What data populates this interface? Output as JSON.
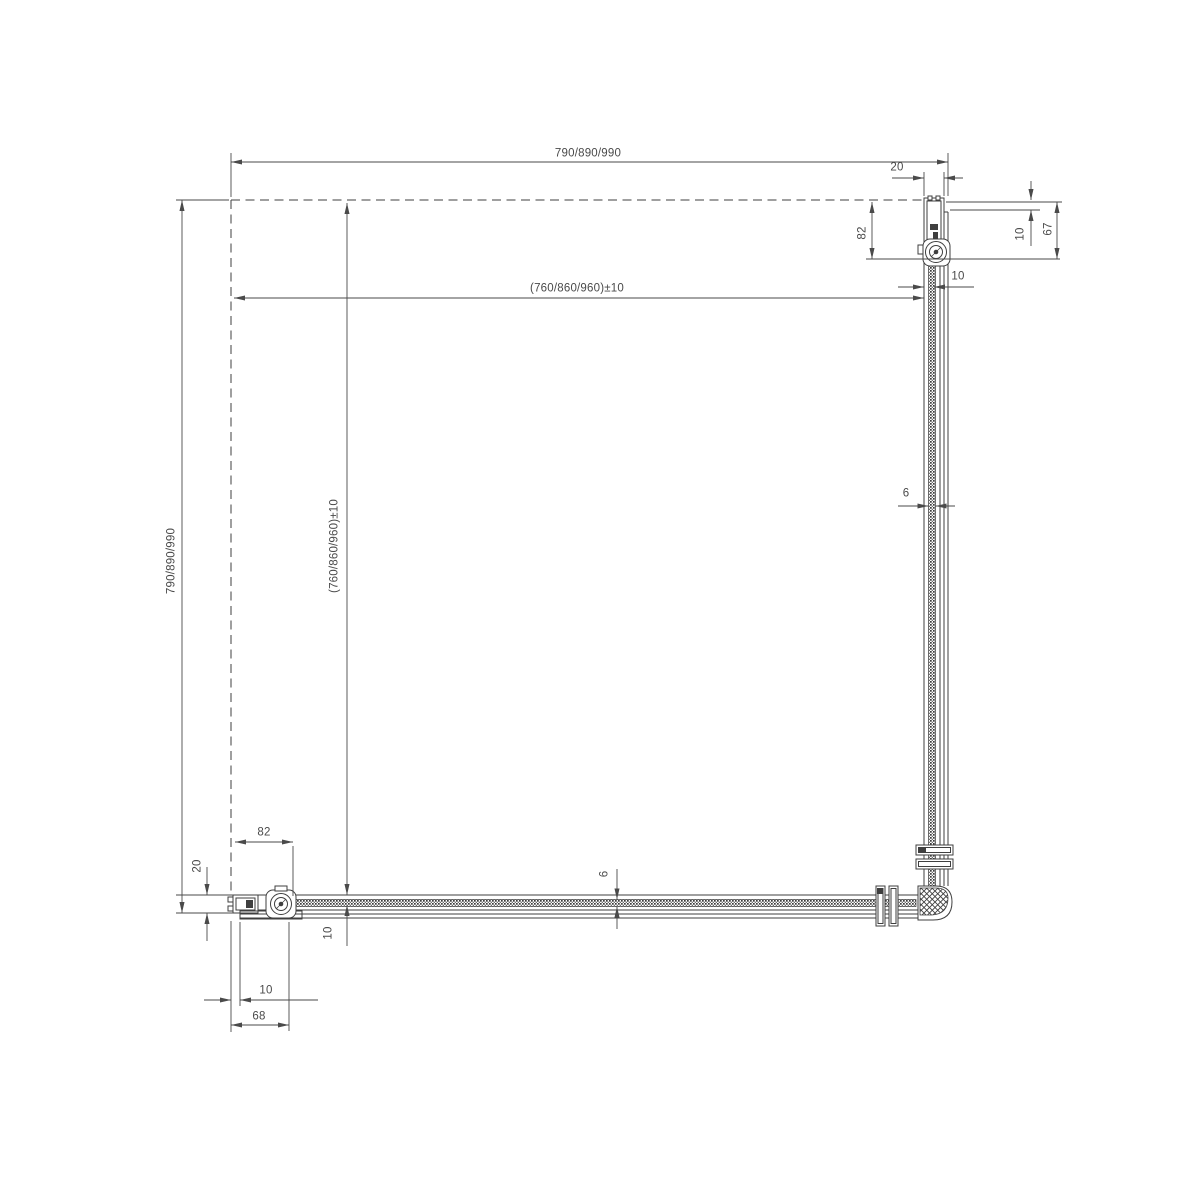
{
  "drawing": {
    "type": "shower-enclosure-corner-plan",
    "colors": {
      "background": "#ffffff",
      "line": "#3f3f3f",
      "dimension": "#4a4a4a"
    },
    "dimensions": {
      "width_overall": "790/890/990",
      "width_internal": "(760/860/960)±10",
      "height_overall": "790/890/990",
      "height_internal": "(760/860/960)±10",
      "top_profile_width": "20",
      "top_wall_to_roller": "82",
      "top_wall_gap": "10",
      "top_corner_depth": "67",
      "top_glass_gap": "10",
      "glass_thickness_side": "6",
      "glass_thickness_front": "6",
      "bottom_wall_to_roller": "82",
      "bottom_profile_width": "20",
      "bottom_glass_gap": "10",
      "bottom_wall_gap": "10",
      "bottom_profile_depth": "68"
    }
  }
}
